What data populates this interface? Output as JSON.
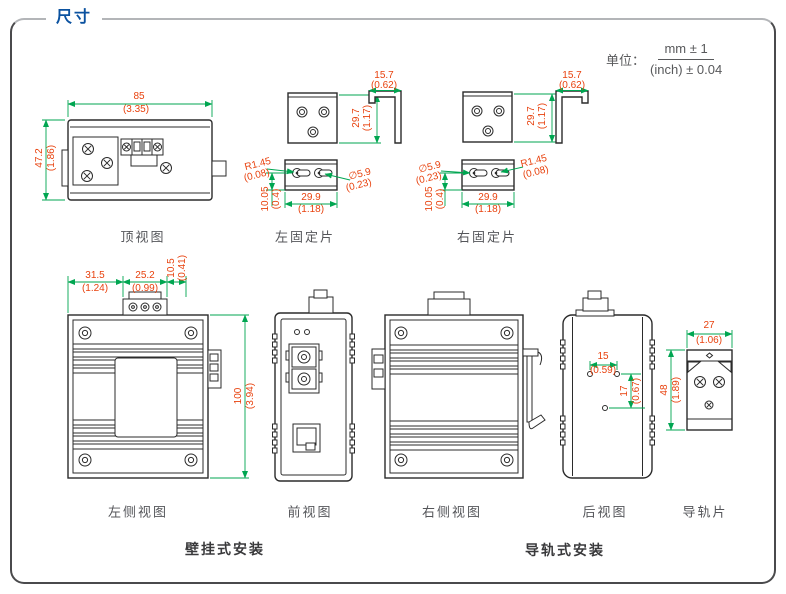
{
  "title": "尺寸",
  "unit": {
    "label": "单位：",
    "numerator": "mm ± 1",
    "denominator": "(inch) ± 0.04"
  },
  "colors": {
    "dimension_text": "#e8420e",
    "dimension_line": "#00a651",
    "outline": "#2b2b2b",
    "title_blue": "#0b52a0"
  },
  "sections": {
    "wall_mount": "壁挂式安装",
    "din_mount": "导轨式安装"
  },
  "views": {
    "top": {
      "label": "顶视图",
      "width": {
        "mm": "85",
        "inch": "(3.35)"
      },
      "height": {
        "mm": "47.2",
        "inch": "(1.86)"
      }
    },
    "left_plate": {
      "label": "左固定片",
      "height": {
        "mm": "29.7",
        "inch": "(1.17)"
      },
      "depth": {
        "mm": "15.7",
        "inch": "(0.62)"
      },
      "slot_radius": {
        "mm": "R1.45",
        "inch": "(0.08)"
      },
      "hole_diameter": {
        "mm": "∅5.9",
        "inch": "(0.23)"
      },
      "hole_offset": {
        "mm": "10.05",
        "inch": "(0.4)"
      },
      "hole_spacing": {
        "mm": "29.9",
        "inch": "(1.18)"
      }
    },
    "right_plate": {
      "label": "右固定片",
      "height": {
        "mm": "29.7",
        "inch": "(1.17)"
      },
      "depth": {
        "mm": "15.7",
        "inch": "(0.62)"
      },
      "slot_radius": {
        "mm": "R1.45",
        "inch": "(0.08)"
      },
      "hole_diameter": {
        "mm": "∅5.9",
        "inch": "(0.23)"
      },
      "hole_offset": {
        "mm": "10.05",
        "inch": "(0.4)"
      },
      "hole_spacing": {
        "mm": "29.9",
        "inch": "(1.18)"
      }
    },
    "left_side": {
      "label": "左侧视图",
      "offset": {
        "mm": "31.5",
        "inch": "(1.24)"
      },
      "terminal_width": {
        "mm": "25.2",
        "inch": "(0.99)"
      },
      "edge_offset": {
        "mm": "10.5",
        "inch": "(0.41)"
      },
      "height": {
        "mm": "100",
        "inch": "(3.94)"
      }
    },
    "front": {
      "label": "前视图"
    },
    "right_side": {
      "label": "右侧视图"
    },
    "rear": {
      "label": "后视图",
      "hole_spacing_h": {
        "mm": "15",
        "inch": "(0.59)"
      },
      "hole_spacing_v": {
        "mm": "17",
        "inch": "(0.67)"
      }
    },
    "rail_plate": {
      "label": "导轨片",
      "width": {
        "mm": "27",
        "inch": "(1.06)"
      },
      "height": {
        "mm": "48",
        "inch": "(1.89)"
      }
    }
  }
}
